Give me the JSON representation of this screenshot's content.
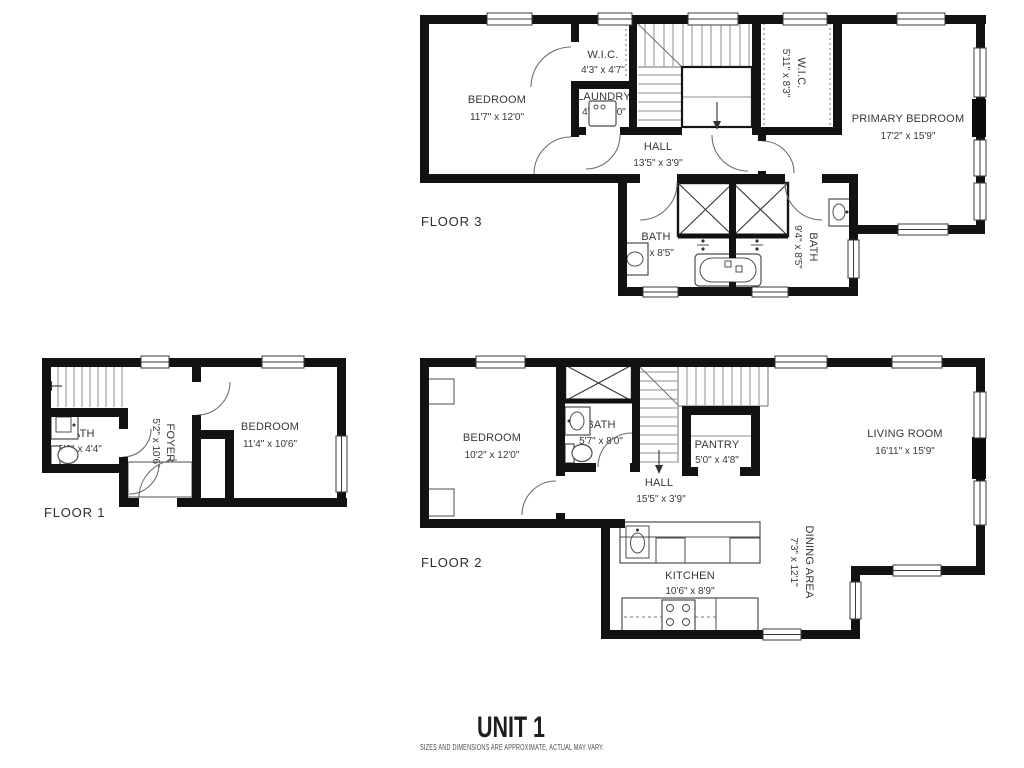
{
  "footer": {
    "unit": "UNIT 1",
    "disclaimer": "SIZES AND DIMENSIONS ARE APPROXIMATE, ACTUAL MAY VARY."
  },
  "colors": {
    "wall": "#121212",
    "thin_line": "#8f8f8f",
    "text": "#383838",
    "background": "#ffffff"
  },
  "floors": [
    {
      "label": "FLOOR 3",
      "rooms": [
        {
          "name": "BEDROOM",
          "dims": "11'7\" x 12'0\""
        },
        {
          "name": "W.I.C.",
          "dims": "4'3\" x 4'7\""
        },
        {
          "name": "LAUNDRY",
          "dims": "4'3\" x 3'0\""
        },
        {
          "name": "HALL",
          "dims": "13'5\" x 3'9\""
        },
        {
          "name": "W.I.C.",
          "dims": "5'11\" x 8'3\""
        },
        {
          "name": "PRIMARY BEDROOM",
          "dims": "17'2\" x 15'9\""
        },
        {
          "name": "BATH",
          "dims": "8'1\" x 8'5\""
        },
        {
          "name": "BATH",
          "dims": "9'4\" x 8'5\""
        }
      ]
    },
    {
      "label": "FLOOR 1",
      "rooms": [
        {
          "name": "BATH",
          "dims": "5'6\" x 4'4\""
        },
        {
          "name": "FOYER",
          "dims": "5'2\" x 10'6\""
        },
        {
          "name": "BEDROOM",
          "dims": "11'4\" x 10'6\""
        }
      ]
    },
    {
      "label": "FLOOR 2",
      "rooms": [
        {
          "name": "BEDROOM",
          "dims": "10'2\" x 12'0\""
        },
        {
          "name": "BATH",
          "dims": "5'7\" x 8'0\""
        },
        {
          "name": "PANTRY",
          "dims": "5'0\" x 4'8\""
        },
        {
          "name": "HALL",
          "dims": "15'5\" x 3'9\""
        },
        {
          "name": "LIVING ROOM",
          "dims": "16'11\" x 15'9\""
        },
        {
          "name": "KITCHEN",
          "dims": "10'6\" x 8'9\""
        },
        {
          "name": "DINING AREA",
          "dims": "7'3\" x 12'1\""
        }
      ]
    }
  ]
}
